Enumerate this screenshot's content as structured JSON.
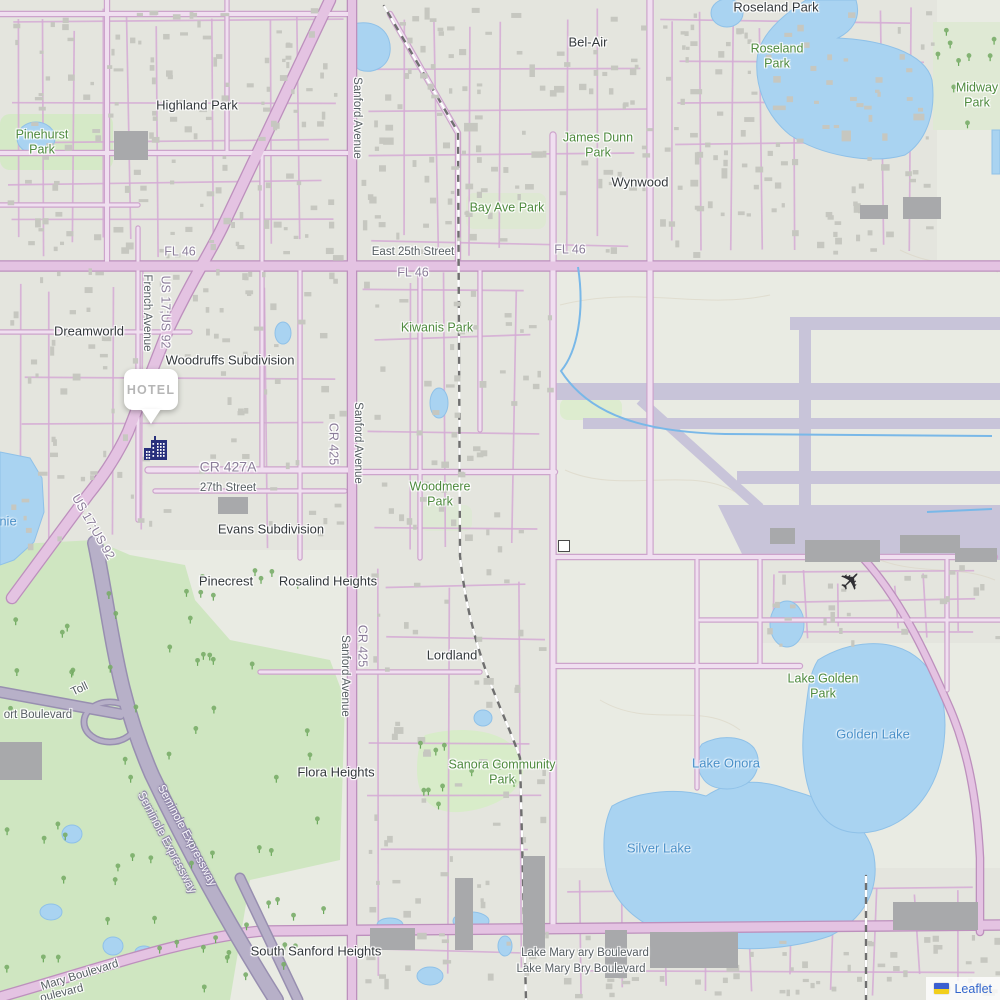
{
  "map": {
    "marker": {
      "label": "HOTEL",
      "x": 150,
      "y": 370
    },
    "attribution": {
      "link_label": "Leaflet",
      "link_color": "#3366cc",
      "flag_top": "#3b5fd0",
      "flag_bottom": "#f2cf1c"
    },
    "icons": {
      "marker_building": "hotel-building-icon",
      "airplane": "airplane-icon",
      "attribution_flag": "ukraine-flag-icon",
      "building_symbol": "building-outline-icon"
    },
    "colors": {
      "land": "#e9ebe3",
      "urban": "#e3e4dd",
      "water": "#a9d3f1",
      "park_green": "#cfe6c1",
      "road_pink": "#e4c3e2",
      "road_casing": "#bd90bd",
      "highway_gray": "#b7b0c8",
      "runway_lavender": "#c8c4d9",
      "building_gray": "#c6c7c0",
      "marker_navy": "#28307c",
      "place_label": "#33383b",
      "park_label": "#4e8a3e",
      "water_label": "#4a90c8",
      "street_label": "#565e62",
      "ref_label": "#8b7d99"
    },
    "labels": [
      {
        "t": "Roseland Park",
        "c": "place",
        "x": 776,
        "y": 7
      },
      {
        "t": "Roseland\nPark",
        "c": "park",
        "x": 777,
        "y": 56
      },
      {
        "t": "Midway Park",
        "c": "park",
        "x": 977,
        "y": 95
      },
      {
        "t": "Bel-Air",
        "c": "place",
        "x": 588,
        "y": 42
      },
      {
        "t": "Highland Park",
        "c": "place",
        "x": 197,
        "y": 105
      },
      {
        "t": "Pinehurst\nPark",
        "c": "park",
        "x": 42,
        "y": 142
      },
      {
        "t": "James Dunn\nPark",
        "c": "park",
        "x": 598,
        "y": 145
      },
      {
        "t": "Wynwood",
        "c": "place",
        "x": 640,
        "y": 182
      },
      {
        "t": "Bay Ave Park",
        "c": "park",
        "x": 507,
        "y": 208
      },
      {
        "t": "Sanford Avenue",
        "c": "street",
        "x": 356,
        "y": 118,
        "r": 90
      },
      {
        "t": "FL 46",
        "c": "ref",
        "x": 180,
        "y": 252
      },
      {
        "t": "East 25th Street",
        "c": "street",
        "x": 413,
        "y": 253
      },
      {
        "t": "FL 46",
        "c": "ref",
        "x": 413,
        "y": 273
      },
      {
        "t": "FL 46",
        "c": "ref",
        "x": 570,
        "y": 250
      },
      {
        "t": "French Avenue",
        "c": "street",
        "x": 146,
        "y": 313,
        "r": 90
      },
      {
        "t": "US 17;US 92",
        "c": "ref",
        "x": 165,
        "y": 312,
        "r": 90
      },
      {
        "t": "Kiwanis Park",
        "c": "park",
        "x": 437,
        "y": 328
      },
      {
        "t": "Dreamworld",
        "c": "place",
        "x": 89,
        "y": 331
      },
      {
        "t": "Woodruffs Subdivision",
        "c": "place",
        "x": 230,
        "y": 360
      },
      {
        "t": "Sanford Avenue",
        "c": "street",
        "x": 357,
        "y": 443,
        "r": 90
      },
      {
        "t": "CR 425",
        "c": "ref",
        "x": 333,
        "y": 444,
        "r": 90
      },
      {
        "t": "CR 427A",
        "c": "ref big",
        "x": 228,
        "y": 467
      },
      {
        "t": "27th Street",
        "c": "street",
        "x": 228,
        "y": 489
      },
      {
        "t": "Woodmere\nPark",
        "c": "park",
        "x": 440,
        "y": 494
      },
      {
        "t": "nie",
        "c": "water",
        "x": 8,
        "y": 521
      },
      {
        "t": "US 17;US 92",
        "c": "ref",
        "x": 93,
        "y": 527,
        "r": 60
      },
      {
        "t": "Evans Subdivision",
        "c": "place",
        "x": 271,
        "y": 529
      },
      {
        "t": "Pinecrest",
        "c": "place",
        "x": 226,
        "y": 581
      },
      {
        "t": "Rosalind Heights",
        "c": "place",
        "x": 328,
        "y": 581
      },
      {
        "t": "Sanford Avenue",
        "c": "street",
        "x": 344,
        "y": 676,
        "r": 90
      },
      {
        "t": "CR 425",
        "c": "ref",
        "x": 362,
        "y": 646,
        "r": 90
      },
      {
        "t": "Lordland",
        "c": "place",
        "x": 452,
        "y": 655
      },
      {
        "t": "Lake Golden\nPark",
        "c": "park",
        "x": 823,
        "y": 686
      },
      {
        "t": "Toll",
        "c": "street",
        "x": 80,
        "y": 690,
        "r": -25
      },
      {
        "t": "ort Boulevard",
        "c": "street",
        "x": 38,
        "y": 716
      },
      {
        "t": "Lake Onora",
        "c": "water",
        "x": 726,
        "y": 763
      },
      {
        "t": "Flora Heights",
        "c": "place",
        "x": 336,
        "y": 772
      },
      {
        "t": "Sanora Community\nPark",
        "c": "park",
        "x": 502,
        "y": 772
      },
      {
        "t": "Golden Lake",
        "c": "water",
        "x": 873,
        "y": 734
      },
      {
        "t": "Seminole Expressway",
        "c": "hwy",
        "x": 186,
        "y": 836,
        "r": 62
      },
      {
        "t": "Seminole Expressway",
        "c": "hwy",
        "x": 166,
        "y": 843,
        "r": 62
      },
      {
        "t": "Silver Lake",
        "c": "water",
        "x": 659,
        "y": 848
      },
      {
        "t": "South Sanford Heights",
        "c": "place",
        "x": 316,
        "y": 951
      },
      {
        "t": "Lake Mary ary Boulevard",
        "c": "street",
        "x": 585,
        "y": 954
      },
      {
        "t": "Lake Mary Bry Boulevard",
        "c": "street",
        "x": 581,
        "y": 970
      },
      {
        "t": "Mary Boulevard",
        "c": "street",
        "x": 80,
        "y": 976,
        "r": -17
      },
      {
        "t": "oulevard",
        "c": "street",
        "x": 62,
        "y": 994,
        "r": -14
      }
    ]
  }
}
